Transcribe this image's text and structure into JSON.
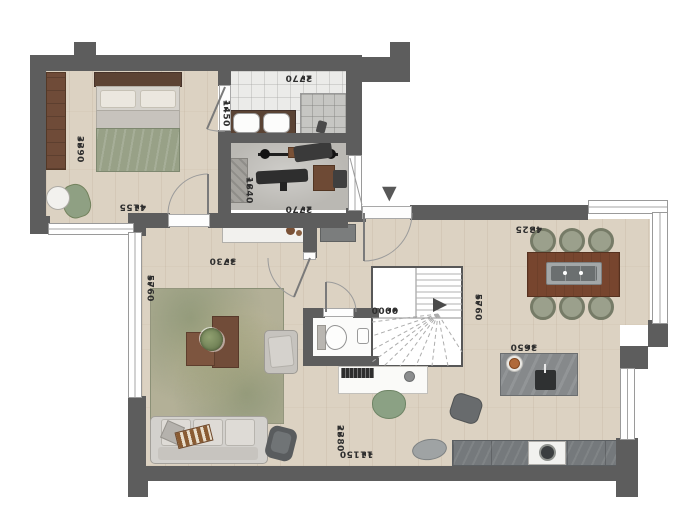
{
  "plan": {
    "type": "ground-floor-plan",
    "entrance_marker": "▼",
    "dimensions": [
      {
        "id": "bedroom-width",
        "value": "4155",
        "orientation": "horizontal"
      },
      {
        "id": "bedroom-depth",
        "value": "3390",
        "orientation": "vertical"
      },
      {
        "id": "bathroom-width",
        "value": "2770",
        "orientation": "horizontal"
      },
      {
        "id": "bathroom-depth",
        "value": "1450",
        "orientation": "vertical"
      },
      {
        "id": "gym-depth",
        "value": "1840",
        "orientation": "vertical"
      },
      {
        "id": "gym-width",
        "value": "2770",
        "orientation": "horizontal"
      },
      {
        "id": "hall-width",
        "value": "3730",
        "orientation": "horizontal"
      },
      {
        "id": "living-depth",
        "value": "5760",
        "orientation": "vertical"
      },
      {
        "id": "entry-floor-level",
        "value": "0000",
        "orientation": "horizontal"
      },
      {
        "id": "stair-zone-depth",
        "value": "5760",
        "orientation": "vertical"
      },
      {
        "id": "dining-width",
        "value": "4325",
        "orientation": "horizontal"
      },
      {
        "id": "kitchen-island-width",
        "value": "3650",
        "orientation": "horizontal"
      },
      {
        "id": "kitchen-depth",
        "value": "2380",
        "orientation": "vertical"
      },
      {
        "id": "total-width",
        "value": "11150",
        "orientation": "horizontal"
      }
    ],
    "colors": {
      "wall": "#5d5d5d",
      "wood_floor": "#dcd2c2",
      "tile_floor": "#ebebe9",
      "gym_floor": "#bab8b3",
      "rug": "#b3b097",
      "rug_accent": "#7d8c69",
      "furniture_wood": "#6f4b38",
      "bed_blanket": "#98a187",
      "sofa": "#d3d1cd",
      "kitchen_gray": "#75797c",
      "dimension_text": "#2f2f2f"
    }
  }
}
